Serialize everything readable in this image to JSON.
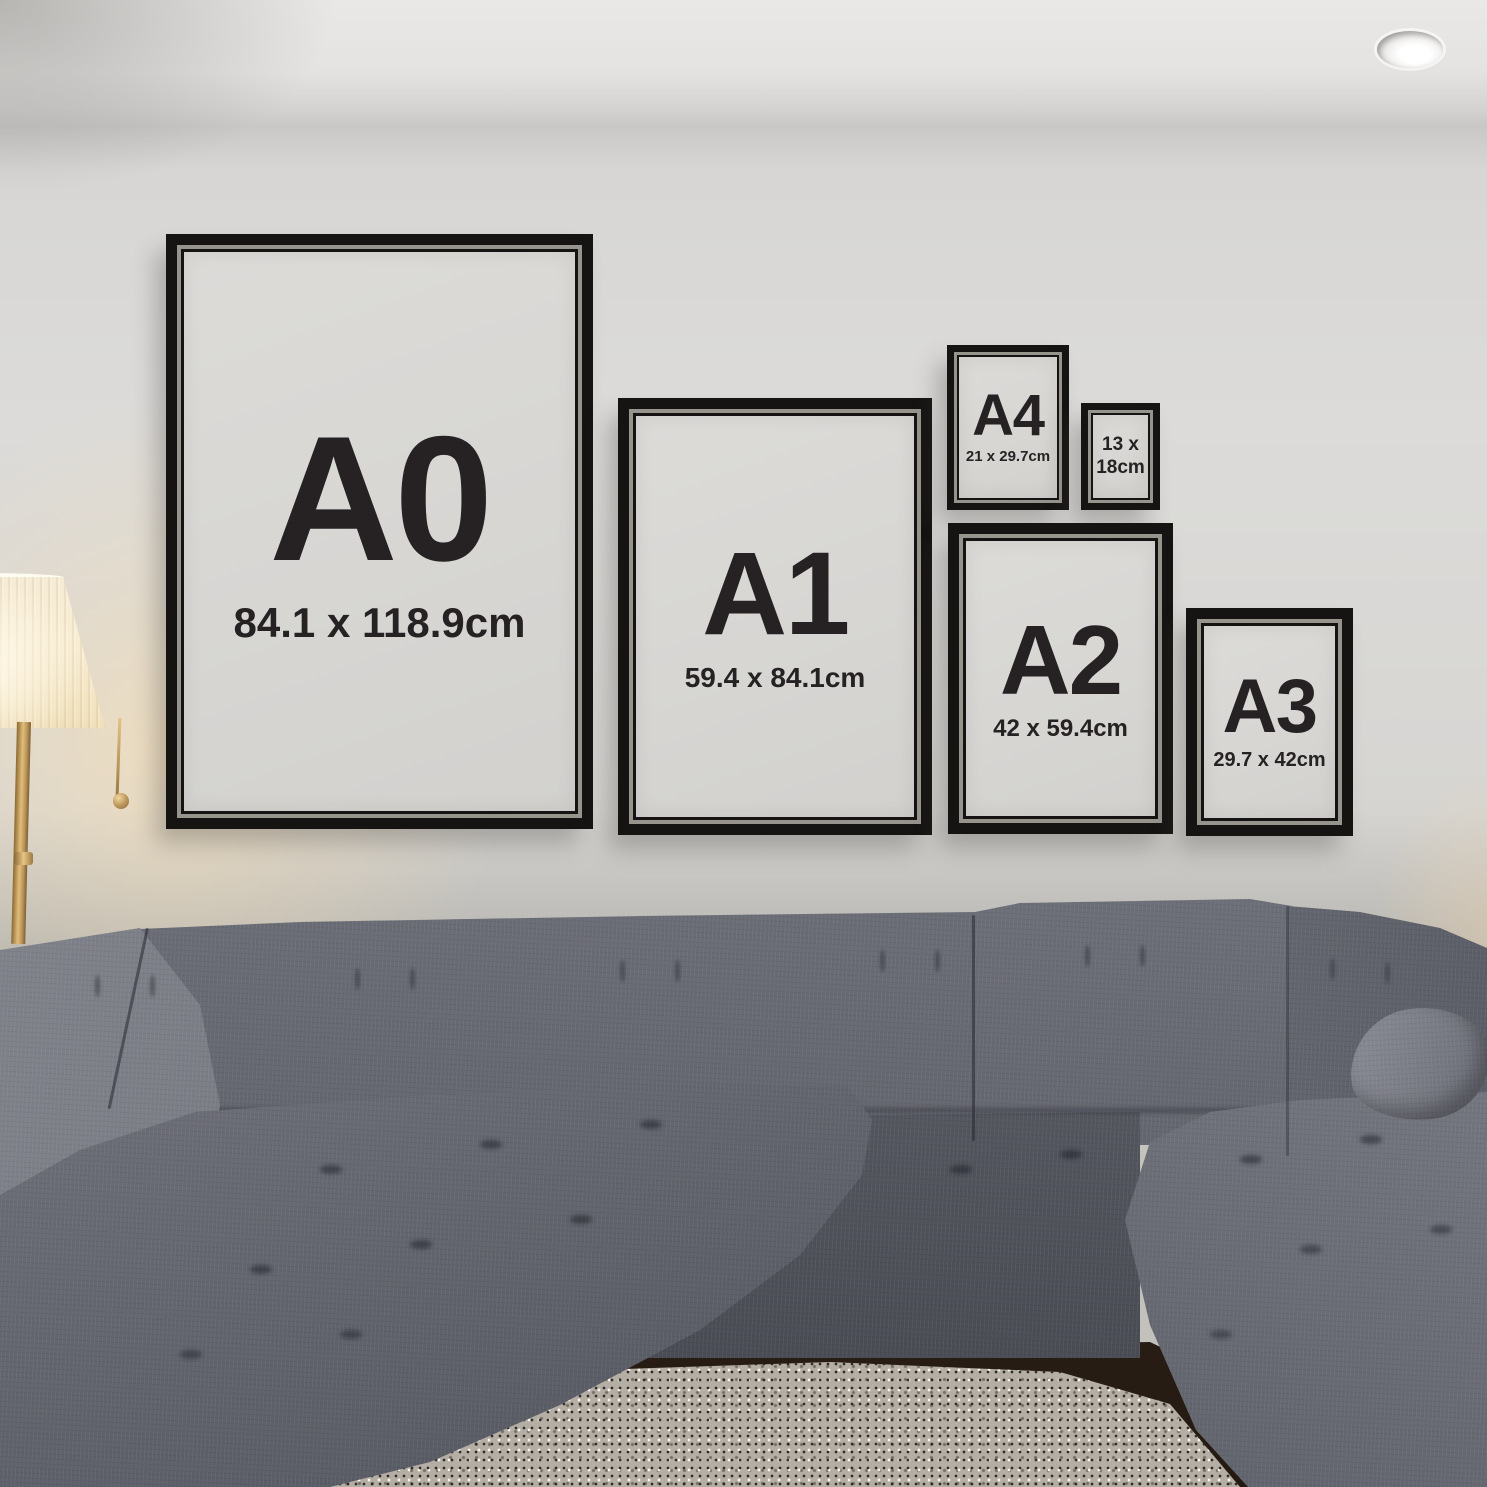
{
  "frames": [
    {
      "id": "a0",
      "label": "A0",
      "size": "84.1 x 118.9cm"
    },
    {
      "id": "a1",
      "label": "A1",
      "size": "59.4 x 84.1cm"
    },
    {
      "id": "a4",
      "label": "A4",
      "size": "21 x 29.7cm"
    },
    {
      "id": "13x18",
      "label": "",
      "size": "13 x\n18cm"
    },
    {
      "id": "a2",
      "label": "A2",
      "size": "42 x 59.4cm"
    },
    {
      "id": "a3",
      "label": "A3",
      "size": "29.7 x 42cm"
    }
  ],
  "palette": {
    "frame": "#161413",
    "bevel": "#97948e",
    "paper": "#d7d6d3",
    "ink": "#262224",
    "wall": "#dcdbd9",
    "ceiling": "#e9e8e6",
    "sofa": "#74767f",
    "sofa_light": "#8b8d96",
    "sofa_dark": "#5c5e67",
    "sofa_deep": "#45474f",
    "rug": "#b4aea5",
    "floor": "#3a2a1d",
    "shade": "#f6ecd6",
    "shade_deep": "#f0e0ba",
    "gold": "#b8935a",
    "gold_dark": "#8a6a33"
  }
}
